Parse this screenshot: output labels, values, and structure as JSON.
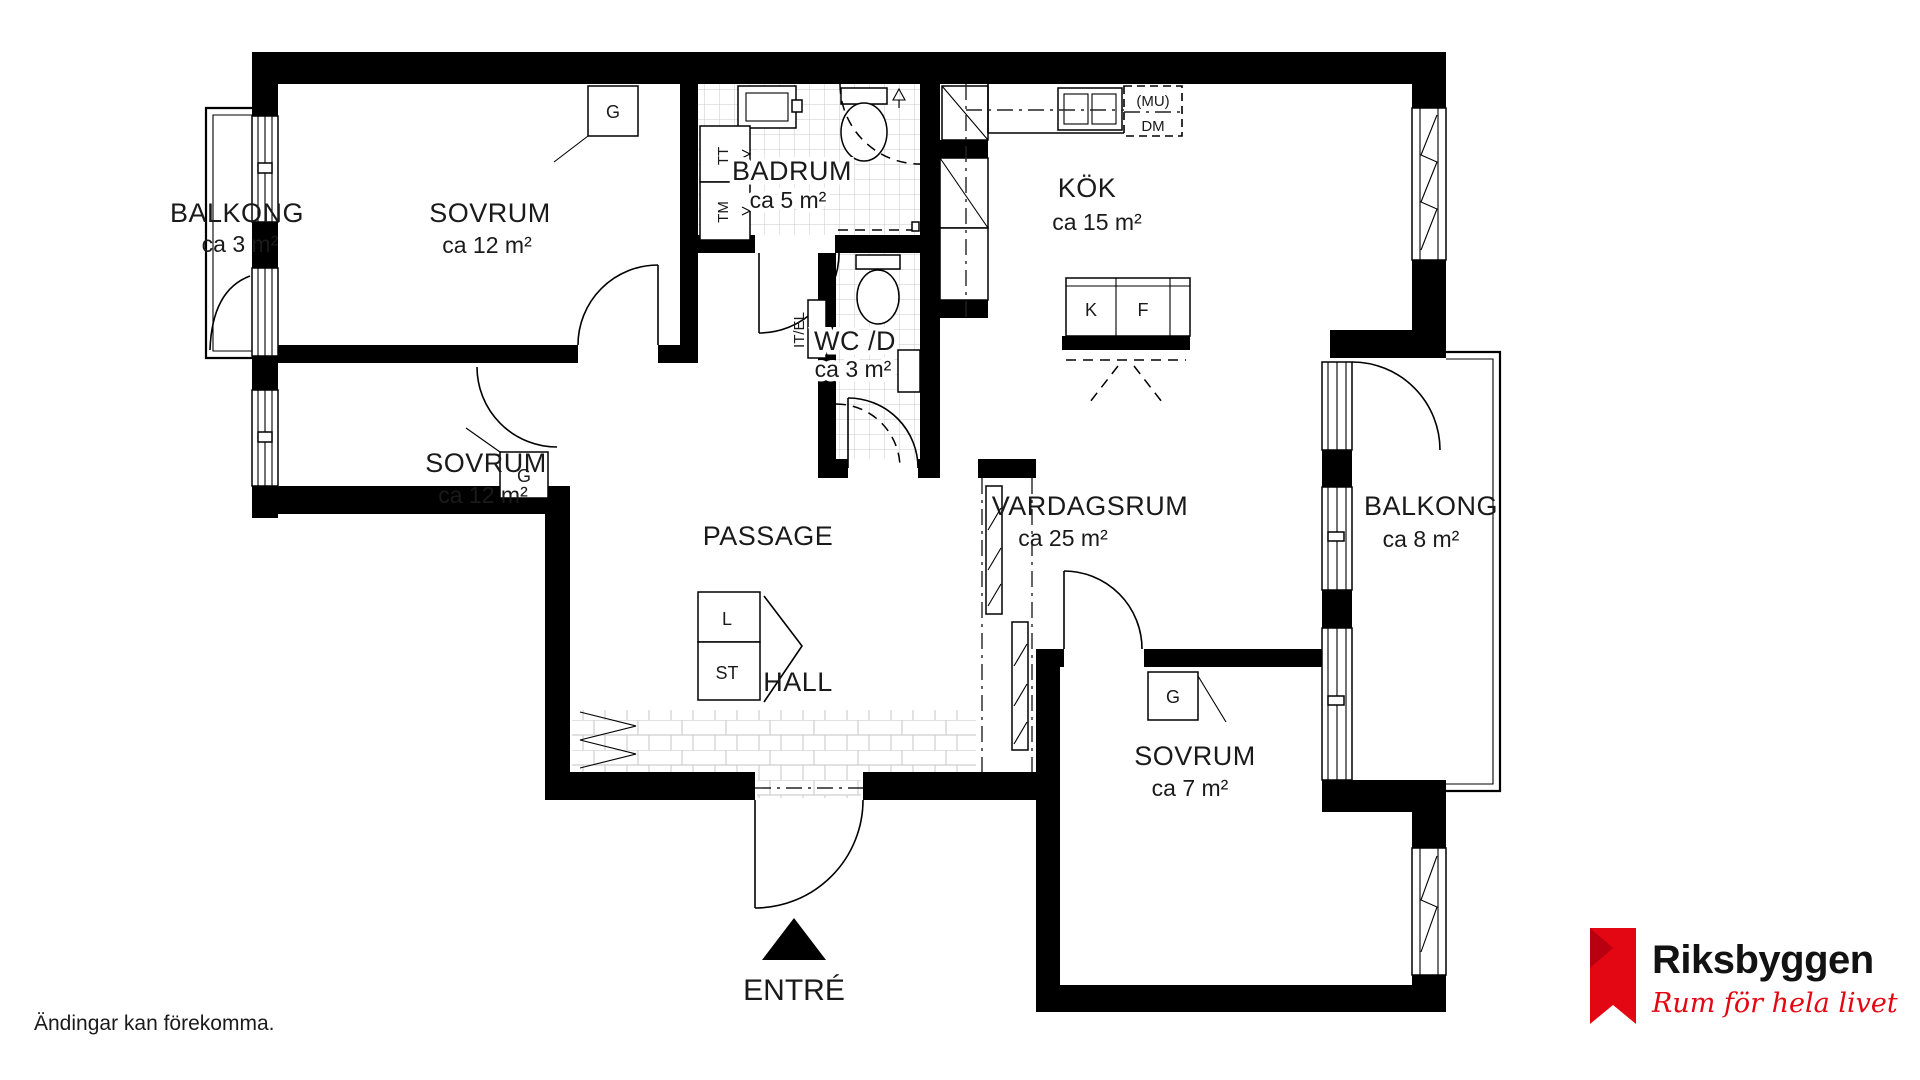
{
  "plan": {
    "rooms": [
      {
        "name": "BALKONG",
        "area": "ca 3 m²"
      },
      {
        "name": "SOVRUM",
        "area": "ca 12 m²"
      },
      {
        "name": "BADRUM",
        "area": "ca 5 m²"
      },
      {
        "name": "KÖK",
        "area": "ca 15 m²"
      },
      {
        "name": "SOVRUM",
        "area": "ca 12 m²"
      },
      {
        "name": "WC /D",
        "area": "ca 3 m²"
      },
      {
        "name": "PASSAGE",
        "area": ""
      },
      {
        "name": "VARDAGSRUM",
        "area": "ca 25 m²"
      },
      {
        "name": "BALKONG",
        "area": "ca 8 m²"
      },
      {
        "name": "HALL",
        "area": ""
      },
      {
        "name": "SOVRUM",
        "area": "ca 7 m²"
      }
    ],
    "closets": {
      "g": "G",
      "l": "L",
      "st": "ST"
    },
    "laundry": {
      "tt": "TT",
      "tm": "TM"
    },
    "kitchen": {
      "k": "K",
      "f": "F",
      "mu": "(MU)",
      "dm": "DM"
    },
    "tech": {
      "itel": "IT/EL"
    },
    "entrance_label": "ENTRÉ"
  },
  "footer": {
    "disclaimer": "Ändingar kan förekomma."
  },
  "logo": {
    "brand": "Riksbyggen",
    "tagline": "Rum för hela livet",
    "brand_red": "#e30613"
  }
}
